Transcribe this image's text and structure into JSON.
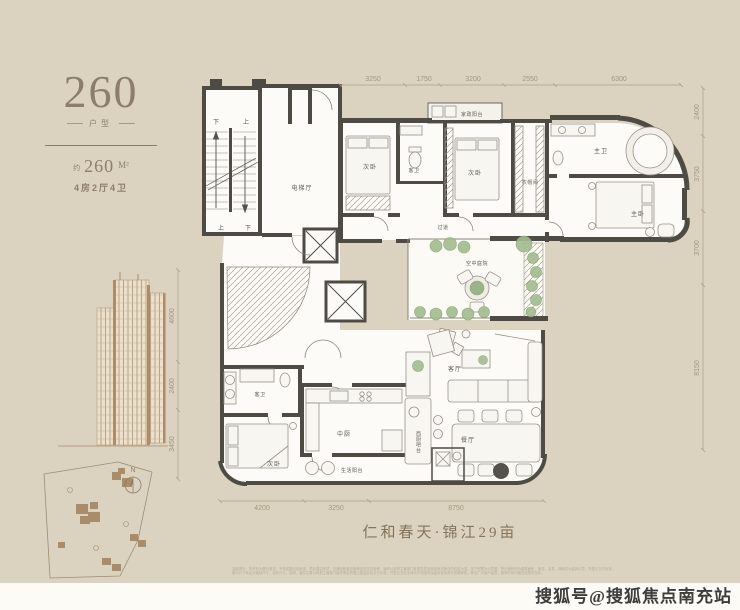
{
  "page": {
    "background": "#dbd3bf",
    "accent": "#8d7e6b",
    "wall_color": "#4e4b45",
    "plant_color": "#a3bd8f"
  },
  "sidebar": {
    "model_number": "260",
    "model_caption": "户型",
    "area_approx_label": "约",
    "area_value": "260",
    "area_unit": "M²",
    "spec_text": "4房2厅4卫",
    "compass_n": "N"
  },
  "plan": {
    "project_title": "仁和春天·锦江29亩",
    "stair_labels": {
      "top_left": "下",
      "top_right": "上",
      "bottom_left": "上",
      "bottom_right": "下"
    },
    "rooms": {
      "elevator_hall": "电梯厅",
      "bedroom_top": "次卧",
      "guest_bath_top": "客卫",
      "laundry_balcony": "家政阳台",
      "bedroom_mid": "次卧",
      "cloakroom": "衣帽间",
      "corridor": "过道",
      "master_bath": "主卫",
      "master_bedroom": "主卧",
      "courtyard": "空中庭院",
      "living_room": "客厅",
      "dining_room": "餐厅",
      "west_kitchen_bar": "西厨吧台",
      "chinese_kitchen": "中厨",
      "service_balcony": "生活阳台",
      "guest_bath_bottom": "客卫",
      "bedroom_bottom": "次卧"
    },
    "dimensions": {
      "top": [
        "3250",
        "1750",
        "3200",
        "2550",
        "6300"
      ],
      "right": [
        "2400",
        "3750",
        "3700",
        "8150"
      ],
      "bottom": [
        "4200",
        "3250",
        "8750"
      ],
      "left": [
        "4600",
        "2400",
        "3450"
      ]
    }
  },
  "footer": {
    "disclaimer_line1": "温馨提示：本资料为要约邀请，不构成要约或承诺，项目周边环境、交通及配套设施等信息仅供参考，最终以政府主管部门批准文件及商品房买卖合同约定为准。本户型图为示意图，所示面积均为建筑面积，家具、洁具、绿植仅为装饰示意，不属于交付标准。",
    "disclaimer_line2": "图中尺寸标注为轴线尺寸，实际尺寸、结构、管井位置以规划主管部门最终审定的施工图及实际交付为准；开发企业在法律允许范围内保留对宣传资料的解释权。敬请广大客户留意，购房时请仔细查验相关文件。",
    "watermark": "搜狐号@搜狐焦点南充站"
  }
}
